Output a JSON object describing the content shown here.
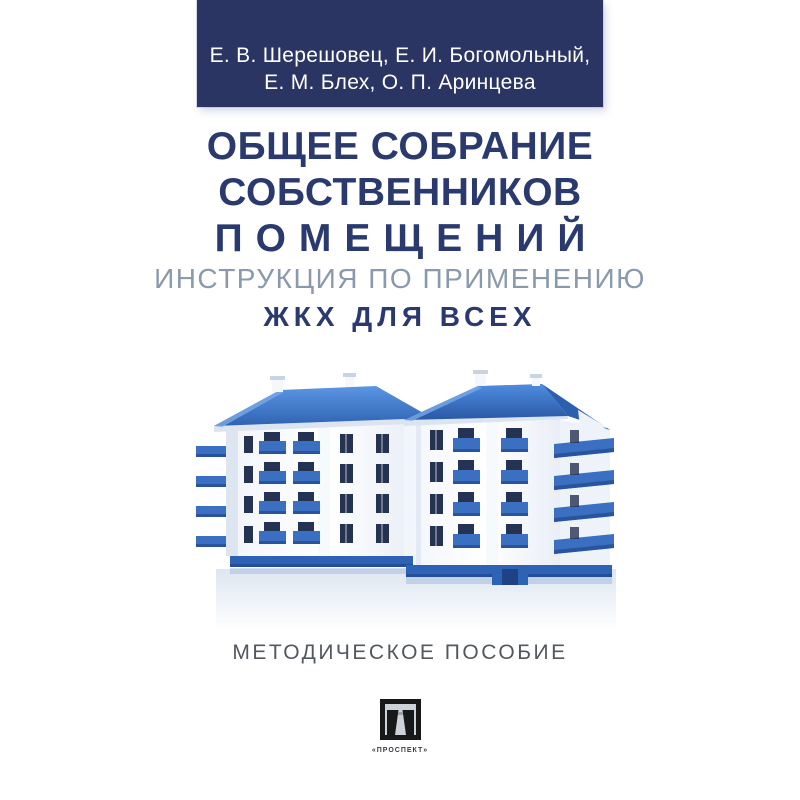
{
  "cover": {
    "authors_band": {
      "line1": "Е. В. Шерешовец, Е. И. Богомольный,",
      "line2": "Е. М. Блех, О. П. Аринцева",
      "bg_color": "#2a3563",
      "text_color": "#ffffff"
    },
    "title": {
      "line1": "ОБЩЕЕ СОБРАНИЕ",
      "line2": "СОБСТВЕННИКОВ",
      "line3": "ПОМЕЩЕНИЙ",
      "color": "#2b3a6e"
    },
    "subtitle": "ИНСТРУКЦИЯ ПО ПРИМЕНЕНИЮ",
    "tagline": "ЖКХ ДЛЯ ВСЕХ",
    "edition_type": "МЕТОДИЧЕСКОЕ ПОСОБИЕ",
    "publisher": {
      "name": "«ПРОСПЕКТ»",
      "logo_icon": "prospekt-gate-icon",
      "logo_color": "#17181a"
    },
    "illustration": {
      "icon": "apartment-buildings-illustration",
      "roof_color": "#3b7dd8",
      "balcony_color": "#3a6fc2",
      "base_color": "#2e62b4",
      "window_color": "#253352",
      "wall_color": "#ffffff"
    }
  }
}
